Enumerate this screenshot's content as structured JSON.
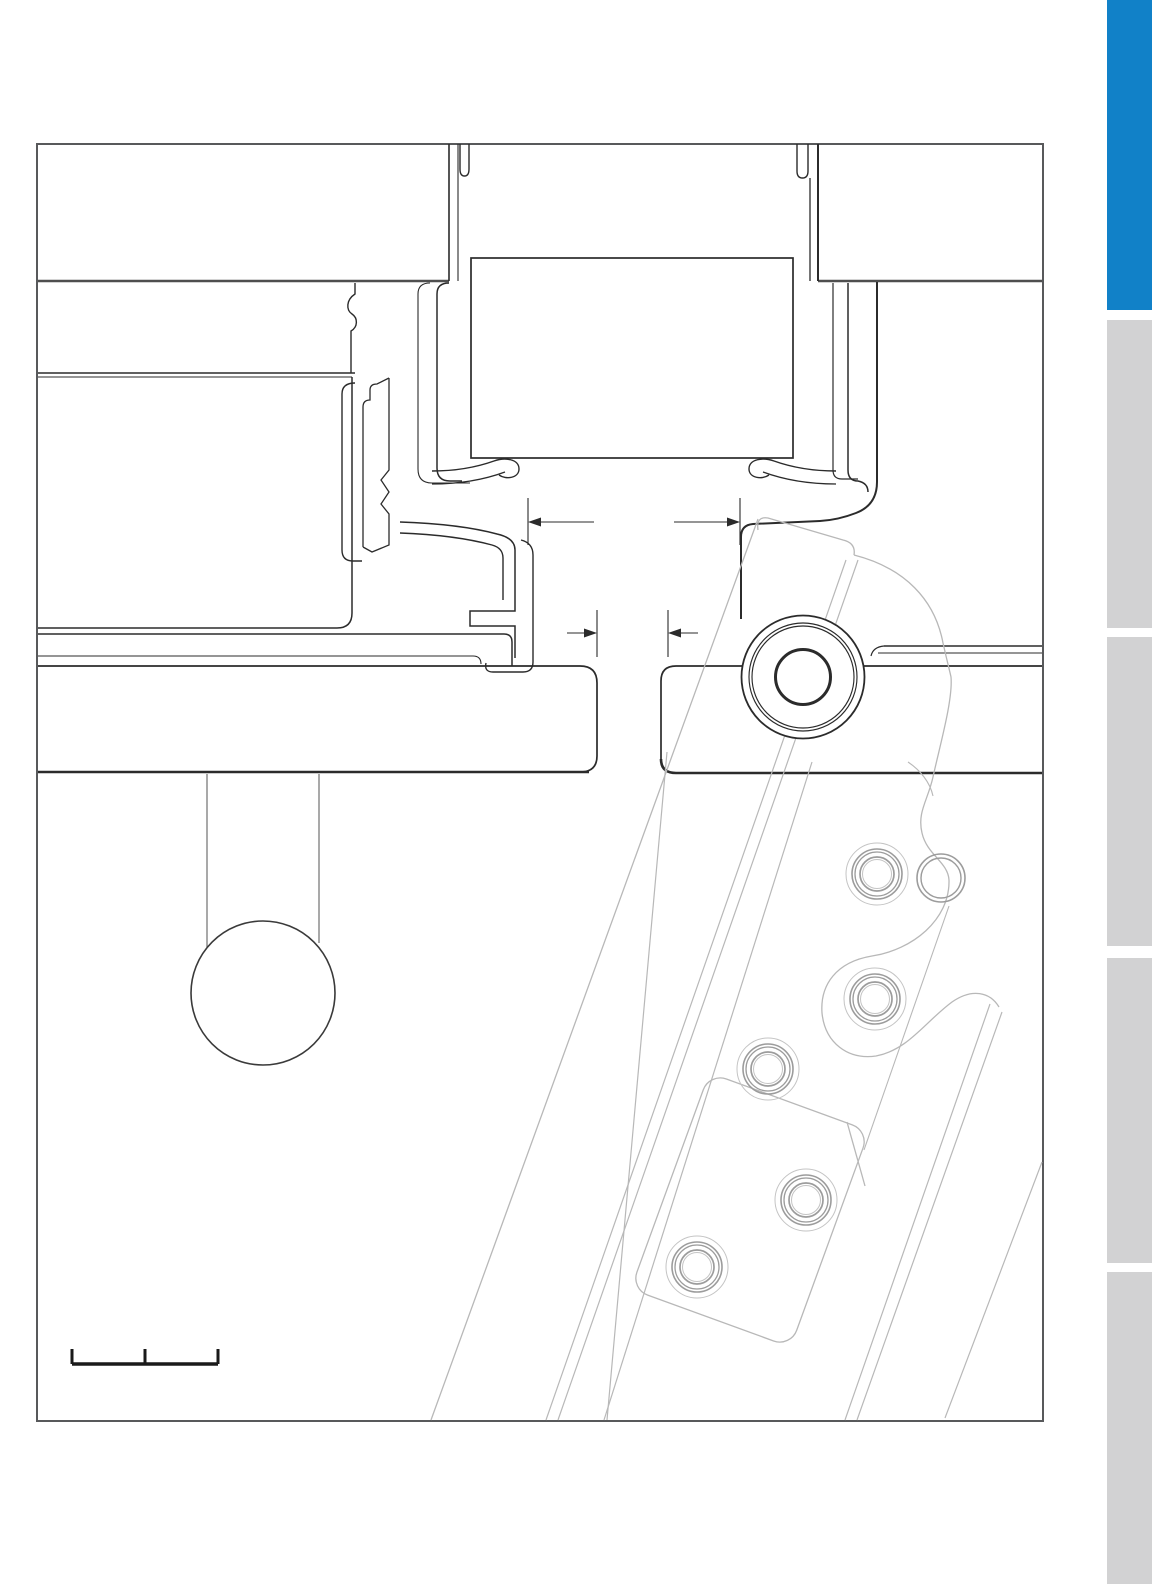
{
  "page": {
    "width": 1152,
    "height": 1584,
    "background": "#ffffff",
    "kind": "technical-section-drawing-page"
  },
  "colors": {
    "frame_border": "#58595b",
    "line_dark": "#2b2b2b",
    "line_medium": "#4f4f4f",
    "line_ghost": "#b8b8b8",
    "line_pipe": "#707070",
    "screw_ring": "#9c9c9c",
    "screw_halo": "#c4c4c4",
    "tab_active": "#1181c8",
    "tab_inactive": "#d2d2d3",
    "scale_bar": "#1a1a1a"
  },
  "drawing_frame": {
    "x": 37,
    "y": 144,
    "width": 1006,
    "height": 1277
  },
  "sidebar_tabs": {
    "x": 1107,
    "width": 45,
    "items": [
      {
        "id": "tab-1",
        "active": true,
        "y": 0,
        "height": 310
      },
      {
        "id": "tab-2",
        "active": false,
        "y": 320,
        "height": 308
      },
      {
        "id": "tab-3",
        "active": false,
        "y": 637,
        "height": 309
      },
      {
        "id": "tab-4",
        "active": false,
        "y": 958,
        "height": 305
      },
      {
        "id": "tab-5",
        "active": false,
        "y": 1272,
        "height": 312
      }
    ]
  },
  "hinge": {
    "cx": 803,
    "cy": 677,
    "radii": [
      61.5,
      54,
      51,
      27.5
    ]
  },
  "handle": {
    "ball_cx": 263,
    "ball_cy": 993,
    "ball_r": 72,
    "pipe_x1": 207,
    "pipe_x2": 319,
    "pipe_top": 774,
    "pipe_bottom": 946
  },
  "screws": [
    {
      "cx": 877,
      "cy": 874,
      "partial": false
    },
    {
      "cx": 875,
      "cy": 999,
      "partial": false
    },
    {
      "cx": 768,
      "cy": 1069,
      "partial": false
    },
    {
      "cx": 806,
      "cy": 1200,
      "partial": false
    },
    {
      "cx": 697,
      "cy": 1267,
      "partial": false
    },
    {
      "cx": 941,
      "cy": 878,
      "partial": true
    }
  ],
  "dimensions": [
    {
      "id": "dim-gap-upper",
      "y": 522,
      "x1": 528,
      "x2": 740,
      "ext_top": 498,
      "ext_bottom": 545,
      "style": "outward",
      "tail": 66
    },
    {
      "id": "dim-gap-lower",
      "y": 633,
      "x1": 597,
      "x2": 668,
      "ext_top": 610,
      "ext_bottom": 657,
      "style": "inward",
      "tail": 30
    }
  ],
  "scale_bar": {
    "y": 1364,
    "x_start": 72,
    "x_end": 218,
    "tick_positions": [
      72,
      145,
      218
    ],
    "tick_height": 15,
    "bar_thickness": 3.5
  }
}
